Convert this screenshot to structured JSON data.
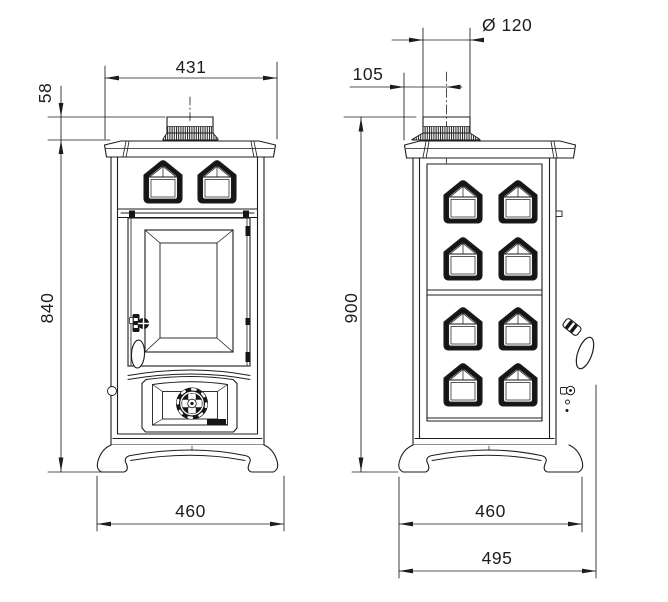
{
  "page": {
    "background": "#ffffff",
    "line_color": "#1d1d1d"
  },
  "drawing": {
    "type": "technical-drawing",
    "subject": "cast-iron stove, front and side elevations with dimensions",
    "front_view": {
      "label": "front view",
      "dims": {
        "top_width": "431",
        "flue_collar_height": "58",
        "body_height": "840",
        "base_width": "460"
      }
    },
    "side_view": {
      "label": "side view",
      "dims": {
        "flue_diameter": "Ø 120",
        "flue_center_offset": "105",
        "overall_height": "900",
        "base_depth": "460",
        "overall_depth": "495"
      }
    }
  }
}
